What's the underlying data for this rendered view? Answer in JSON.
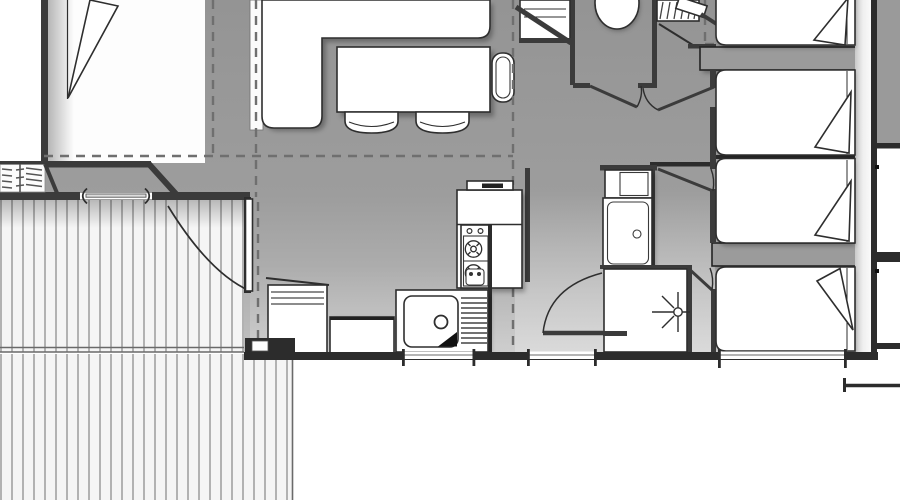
{
  "meta": {
    "title": "Mobile home floor plan",
    "type": "architectural-floor-plan",
    "visible_text_labels": []
  },
  "palette": {
    "background": "#ffffff",
    "floor_gray": "#979797",
    "floor_gray_light": "#c2c2c2",
    "wall_dark": "#3b3b3b",
    "wall_darker": "#2c2c2c",
    "wall_fill": "#9b9b9b",
    "furniture_white": "#ffffff",
    "outline": "#2e2e2e",
    "deck_board_line": "#8f8f8f",
    "dashed_roof_line": "#6f6f6f"
  },
  "labels": {
    "plan": "mobile home floor plan",
    "deck": "wooden deck terrace",
    "steps": "entry steps",
    "master_bedroom": "master bedroom",
    "double_bed": "double bed with folded blanket",
    "living_room": "living room",
    "sofa": "corner sofa",
    "dining_table": "dining table",
    "chair": "dining chair",
    "kitchen": "kitchen block",
    "hood": "extractor hood",
    "stove": "two-burner stove",
    "worktop": "worktop",
    "faucet": "faucet",
    "sink": "kitchen sink with drainer",
    "cabinet": "kitchen cabinet",
    "wc": "separate WC",
    "toilet": "toilet",
    "dresser": "dresser",
    "wardrobe": "wardrobe shelf",
    "bathroom": "bathroom",
    "washbasin": "washbasin",
    "bathtub": "bathtub",
    "shower": "shower cabin",
    "hallway": "bedroom hallway",
    "bedroom": "bedroom",
    "single_bed": "single bed with folded blanket",
    "door": "door swing",
    "sliding_door": "sliding patio door",
    "window": "window opening",
    "roof_line": "dashed roof overhang line",
    "east_wall": "east exterior wall with windows"
  }
}
